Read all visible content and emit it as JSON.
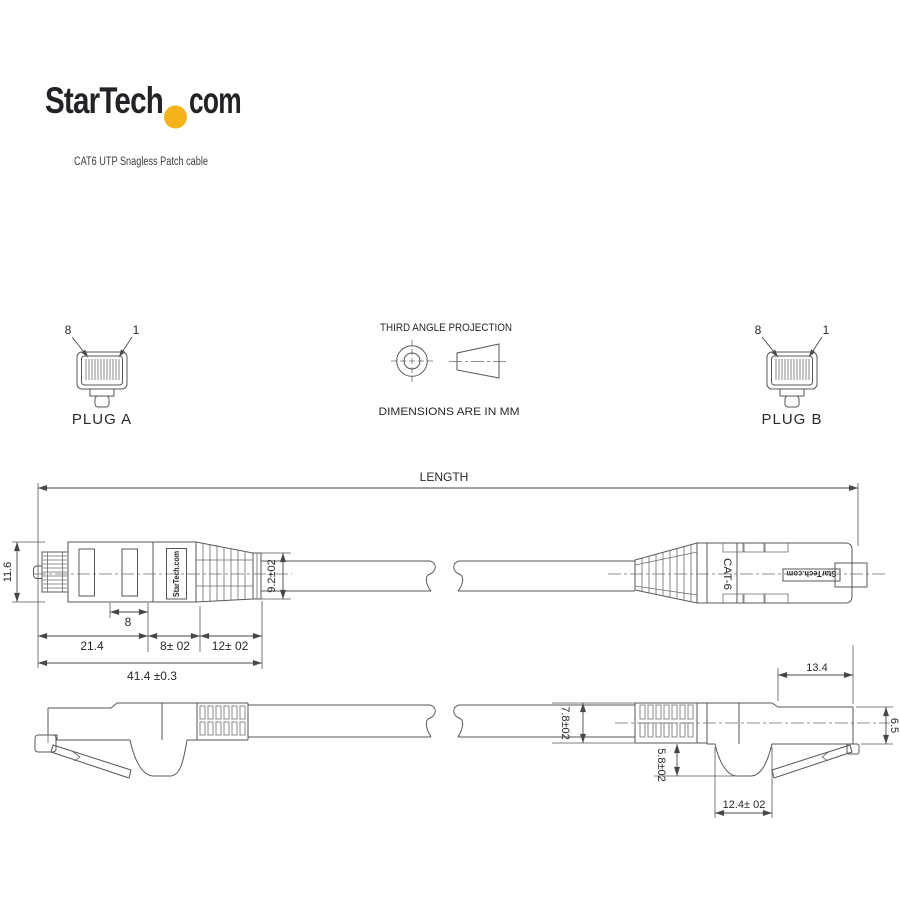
{
  "header": {
    "brand": "StarTech",
    "tld": "com",
    "subtitle": "CAT6 UTP Snagless Patch cable",
    "dot_color": "#F6B21B"
  },
  "projection": {
    "title": "THIRD ANGLE PROJECTION",
    "units": "DIMENSIONS ARE IN MM"
  },
  "plug_a": {
    "label": "PLUG A",
    "pin_8": "8",
    "pin_1": "1"
  },
  "plug_b": {
    "label": "PLUG B",
    "pin_8": "8",
    "pin_1": "1"
  },
  "dims": {
    "length": "LENGTH",
    "plug_height": "11.6",
    "contact_len": "8",
    "body_len": "21.4",
    "mid_len": "8± 02",
    "boot_len": "12± 02",
    "total_len": "41.4 ±0.3",
    "boot_dia": "9.2±02",
    "tip_len": "13.4",
    "cable_dia": "7.8±02",
    "latch_rise": "5.8±02",
    "hump_len": "12.4± 02",
    "tip_height": "6.5"
  },
  "markings": {
    "left_brand": "StarTech.com",
    "category": "CAT-6",
    "right_brand": "StarTech.com"
  },
  "colors": {
    "line": "#55575b",
    "text": "#26282b",
    "background": "#ffffff"
  }
}
